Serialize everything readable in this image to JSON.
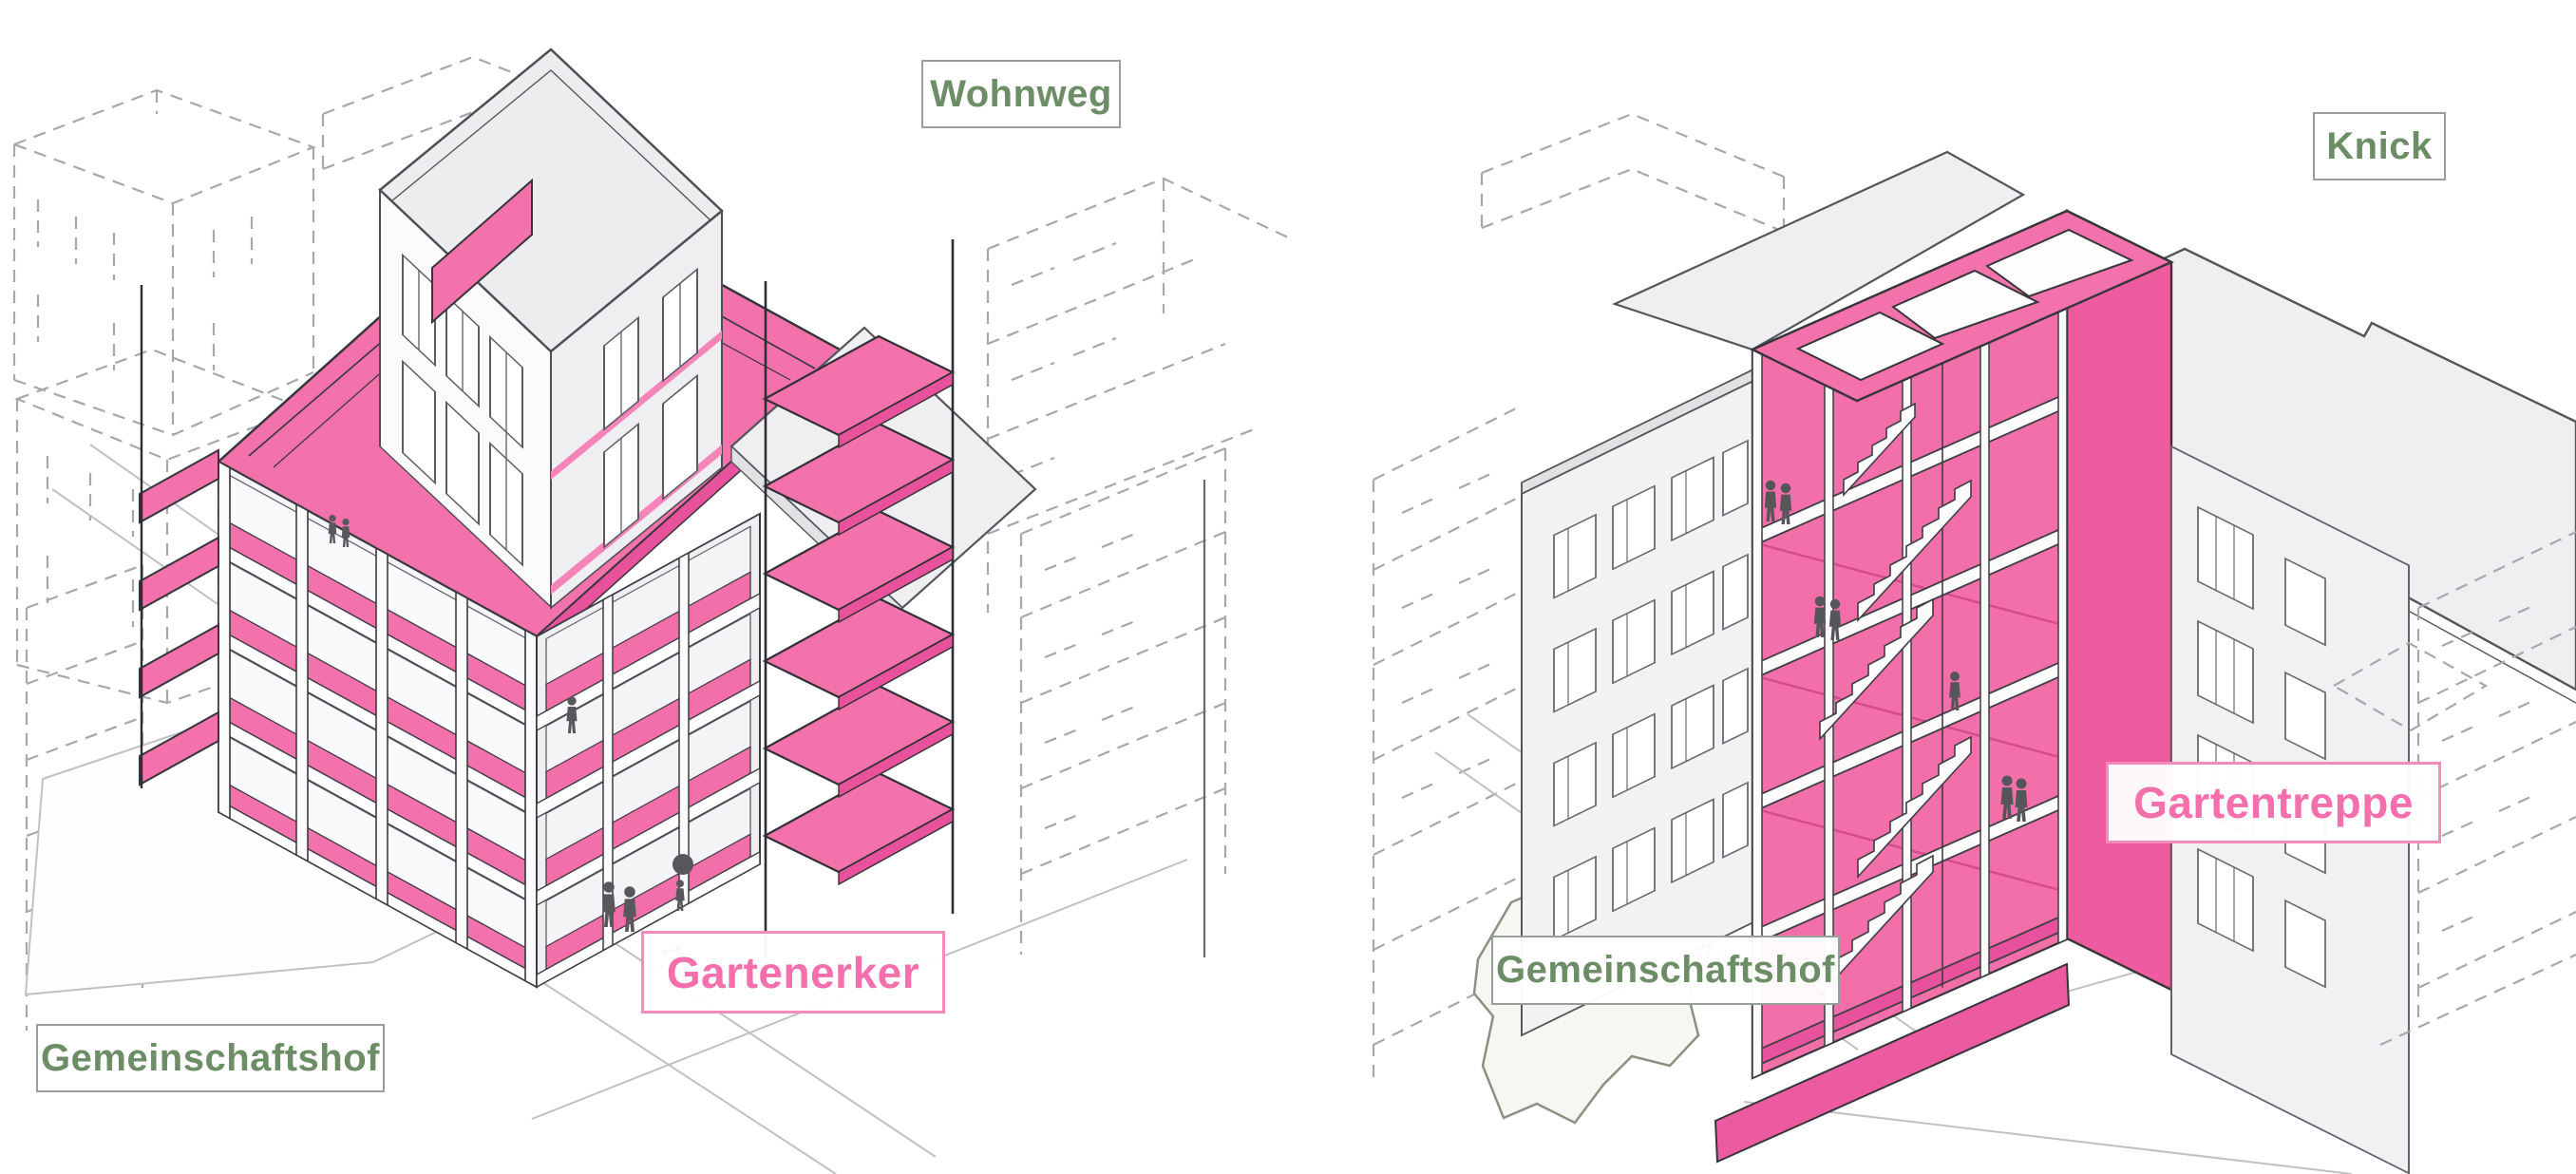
{
  "left_panel": {
    "description": "Axonometric diagram of housing block with pink garden bay balconies",
    "labels": {
      "top_right": "Wohnweg",
      "feature": "Gartenerker",
      "bottom_left": "Gemeinschaftshof"
    }
  },
  "right_panel": {
    "description": "Axonometric diagram of housing block with pink garden stair tower",
    "labels": {
      "top_right": "Knick",
      "feature": "Gartentreppe",
      "bottom_left": "Gemeinschaftshof"
    }
  },
  "colors": {
    "highlight_pink": "#F472AC",
    "highlight_pink_side": "#EE5C9F",
    "highlight_pink_dark": "#E8519B",
    "label_pink_text": "#F56FAD",
    "label_green_text": "#6C8D66",
    "building_gray": "#EDEDEF",
    "outline": "#3A3A40",
    "wireframe_dash": "#A7A7AD"
  }
}
